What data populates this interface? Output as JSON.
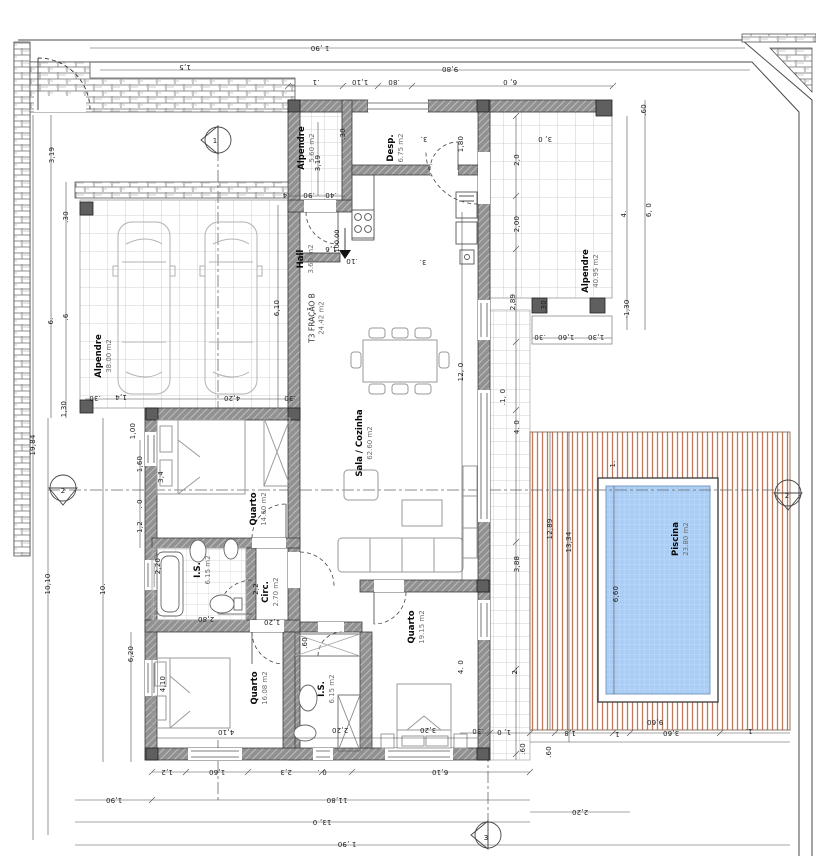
{
  "drawing": {
    "type": "architectural-floor-plan",
    "unit_hint": "m",
    "colors": {
      "pool_water": "#a9cdf4",
      "deck_stripe": "#c1795a",
      "wall_fill": "#919191",
      "line": "#3a3a3a"
    }
  },
  "rooms": [
    {
      "name": "Alpendre",
      "area": "5.60 m2",
      "x": 307,
      "y": 148
    },
    {
      "name": "Desp.",
      "area": "6.75 m2",
      "x": 396,
      "y": 148
    },
    {
      "name": "Hall",
      "area": "3.60 m2",
      "x": 306,
      "y": 259
    },
    {
      "name": "Alpendre",
      "area": "38.00 m2",
      "x": 104,
      "y": 356
    },
    {
      "name": "Alpendre",
      "area": "40.95 m2",
      "x": 591,
      "y": 271
    },
    {
      "name": "T3 FRAÇÃO B",
      "area": "24.42 m2",
      "x": 317,
      "y": 318,
      "light": true
    },
    {
      "name": "Sala / Cozinha",
      "area": "62.60 m2",
      "x": 365,
      "y": 443
    },
    {
      "name": "Quarto",
      "area": "14.60 m2",
      "x": 259,
      "y": 509
    },
    {
      "name": "I.S.",
      "area": "6.15 m2",
      "x": 203,
      "y": 570
    },
    {
      "name": "Circ.",
      "area": "2.70 m2",
      "x": 271,
      "y": 592
    },
    {
      "name": "Quarto",
      "area": "16.08 m2",
      "x": 260,
      "y": 688
    },
    {
      "name": "I.S.",
      "area": "6.15 m2",
      "x": 327,
      "y": 689
    },
    {
      "name": "Quarto",
      "area": "19.15 m2",
      "x": 417,
      "y": 627
    },
    {
      "name": "Piscina",
      "area": "23.80 m2",
      "x": 681,
      "y": 539
    }
  ],
  "dimensions": [
    {
      "t": "1 ,90",
      "x": 320,
      "y": 48,
      "r": 180
    },
    {
      "t": "9,80",
      "x": 450,
      "y": 69,
      "r": 180
    },
    {
      "t": ".1",
      "x": 316,
      "y": 82,
      "r": 180
    },
    {
      "t": "1,10",
      "x": 360,
      "y": 82,
      "r": 180
    },
    {
      "t": ".80",
      "x": 394,
      "y": 82,
      "r": 180
    },
    {
      "t": "6, 0",
      "x": 510,
      "y": 82,
      "r": 180
    },
    {
      "t": "1,5",
      "x": 185,
      "y": 67,
      "r": 180
    },
    {
      "t": "3, 0",
      "x": 545,
      "y": 139,
      "r": 180
    },
    {
      "t": "2,0",
      "x": 517,
      "y": 160,
      "r": -90
    },
    {
      "t": "2,00",
      "x": 517,
      "y": 224,
      "r": -90
    },
    {
      "t": "2,89",
      "x": 513,
      "y": 302,
      "r": -90
    },
    {
      "t": ".30",
      "x": 544,
      "y": 306,
      "r": -90
    },
    {
      "t": ".60",
      "x": 644,
      "y": 110,
      "r": -90
    },
    {
      "t": "4.",
      "x": 624,
      "y": 214,
      "r": -90
    },
    {
      "t": "6, 0",
      "x": 649,
      "y": 210,
      "r": -90
    },
    {
      "t": "-1,30",
      "x": 627,
      "y": 309,
      "r": -90
    },
    {
      "t": ".30",
      "x": 540,
      "y": 337,
      "r": 180
    },
    {
      "t": "1,60",
      "x": 566,
      "y": 337,
      "r": 180
    },
    {
      "t": "1,30",
      "x": 596,
      "y": 337,
      "r": 180
    },
    {
      "t": ".1, 0",
      "x": 503,
      "y": 397,
      "r": -90
    },
    {
      "t": "4. 0",
      "x": 517,
      "y": 427,
      "r": -90
    },
    {
      "t": "3,88",
      "x": 517,
      "y": 564,
      "r": -90
    },
    {
      "t": "2.",
      "x": 515,
      "y": 671,
      "r": -90
    },
    {
      "t": "1.",
      "x": 613,
      "y": 464,
      "r": -90
    },
    {
      "t": "12,89",
      "x": 550,
      "y": 529,
      "r": -90
    },
    {
      "t": "13,34",
      "x": 569,
      "y": 542,
      "r": -90
    },
    {
      "t": "6,60",
      "x": 616,
      "y": 594,
      "r": -90
    },
    {
      "t": "9,60",
      "x": 655,
      "y": 722,
      "r": 180
    },
    {
      "t": ".30",
      "x": 478,
      "y": 731,
      "r": 180
    },
    {
      "t": "1, 0",
      "x": 504,
      "y": 732,
      "r": 180
    },
    {
      "t": ".60",
      "x": 523,
      "y": 749,
      "r": -90
    },
    {
      "t": ".60",
      "x": 549,
      "y": 752,
      "r": -90
    },
    {
      "t": "1,8",
      "x": 570,
      "y": 733,
      "r": 180
    },
    {
      "t": "1.",
      "x": 616,
      "y": 734,
      "r": 180
    },
    {
      "t": "3,60",
      "x": 671,
      "y": 733,
      "r": 180
    },
    {
      "t": "1.",
      "x": 749,
      "y": 731,
      "r": 180
    },
    {
      "t": "2,20",
      "x": 580,
      "y": 812,
      "r": 180
    },
    {
      "t": "1,2",
      "x": 167,
      "y": 772,
      "r": 180
    },
    {
      "t": "1,60",
      "x": 217,
      "y": 772,
      "r": 180
    },
    {
      "t": "2,3",
      "x": 286,
      "y": 772,
      "r": 180
    },
    {
      "t": "0 .",
      "x": 322,
      "y": 772,
      "r": 180
    },
    {
      "t": "6,10",
      "x": 440,
      "y": 772,
      "r": 180
    },
    {
      "t": "1,90",
      "x": 114,
      "y": 800,
      "r": 180
    },
    {
      "t": "11,80",
      "x": 337,
      "y": 800,
      "r": 180
    },
    {
      "t": "13, 0",
      "x": 322,
      "y": 822,
      "r": 180
    },
    {
      "t": "1 ,90",
      "x": 347,
      "y": 844,
      "r": 180
    },
    {
      "t": "19,84",
      "x": 33,
      "y": 445,
      "r": -90
    },
    {
      "t": "3,19",
      "x": 52,
      "y": 155,
      "r": -90
    },
    {
      "t": ".30",
      "x": 66,
      "y": 217,
      "r": -90
    },
    {
      "t": "6.",
      "x": 51,
      "y": 321,
      "r": -90
    },
    {
      "t": ".6",
      "x": 66,
      "y": 317,
      "r": -90
    },
    {
      "t": "1,30",
      "x": 64,
      "y": 409,
      "r": -90
    },
    {
      "t": "10,10",
      "x": 48,
      "y": 584,
      "r": -90
    },
    {
      "t": "10.",
      "x": 103,
      "y": 589,
      "r": -90
    },
    {
      "t": "6,20",
      "x": 131,
      "y": 654,
      "r": -90
    },
    {
      "t": "1,00",
      "x": 133,
      "y": 431,
      "r": -90
    },
    {
      "t": "1,60",
      "x": 140,
      "y": 464,
      "r": -90
    },
    {
      "t": ". 0",
      "x": 140,
      "y": 504,
      "r": -90
    },
    {
      "t": "1,2",
      "x": 140,
      "y": 527,
      "r": -90
    },
    {
      "t": "3,4",
      "x": 161,
      "y": 477,
      "r": -90
    },
    {
      "t": "2,20",
      "x": 158,
      "y": 566,
      "r": -90
    },
    {
      "t": "4,10",
      "x": 163,
      "y": 684,
      "r": -90
    },
    {
      "t": "6,10",
      "x": 277,
      "y": 308,
      "r": -90
    },
    {
      "t": "4,20",
      "x": 232,
      "y": 398,
      "r": 180
    },
    {
      "t": "1,4",
      "x": 121,
      "y": 397,
      "r": 180
    },
    {
      "t": ".30",
      "x": 95,
      "y": 398,
      "r": 180
    },
    {
      "t": ".30",
      "x": 290,
      "y": 398,
      "r": 180
    },
    {
      "t": ".30",
      "x": 343,
      "y": 134,
      "r": -90
    },
    {
      "t": "3,19",
      "x": 318,
      "y": 163,
      "r": -90
    },
    {
      "t": ".4",
      "x": 286,
      "y": 195,
      "r": 180
    },
    {
      "t": ".90",
      "x": 309,
      "y": 195,
      "r": 180
    },
    {
      "t": ".40",
      "x": 331,
      "y": 195,
      "r": 180
    },
    {
      "t": "1,80",
      "x": 461,
      "y": 144,
      "r": -90
    },
    {
      "t": "3.",
      "x": 424,
      "y": 139,
      "r": 180
    },
    {
      "t": "3.",
      "x": 423,
      "y": 262,
      "r": 180
    },
    {
      "t": "1,6",
      "x": 331,
      "y": 249,
      "r": 180
    },
    {
      "t": ".10",
      "x": 352,
      "y": 261,
      "r": 180
    },
    {
      "t": "12, 0",
      "x": 461,
      "y": 372,
      "r": -90
    },
    {
      "t": "2,2",
      "x": 256,
      "y": 589,
      "r": -90
    },
    {
      "t": "2,80",
      "x": 206,
      "y": 619,
      "r": 180
    },
    {
      "t": "1,20",
      "x": 272,
      "y": 622,
      "r": 180
    },
    {
      "t": ".60",
      "x": 305,
      "y": 643,
      "r": -90
    },
    {
      "t": "4,10",
      "x": 226,
      "y": 732,
      "r": 180
    },
    {
      "t": "2,20",
      "x": 340,
      "y": 730,
      "r": 180
    },
    {
      "t": "3,20",
      "x": 428,
      "y": 730,
      "r": 180
    },
    {
      "t": "4. 0",
      "x": 461,
      "y": 667,
      "r": -90
    }
  ],
  "section_markers": [
    {
      "label": "1",
      "x": 215,
      "y": 141
    },
    {
      "label": "2",
      "x": 63,
      "y": 491
    },
    {
      "label": "2",
      "x": 787,
      "y": 496
    },
    {
      "label": "3",
      "x": 486,
      "y": 838
    }
  ],
  "level_marker": {
    "value": "100.00",
    "x": 337,
    "y": 241
  }
}
